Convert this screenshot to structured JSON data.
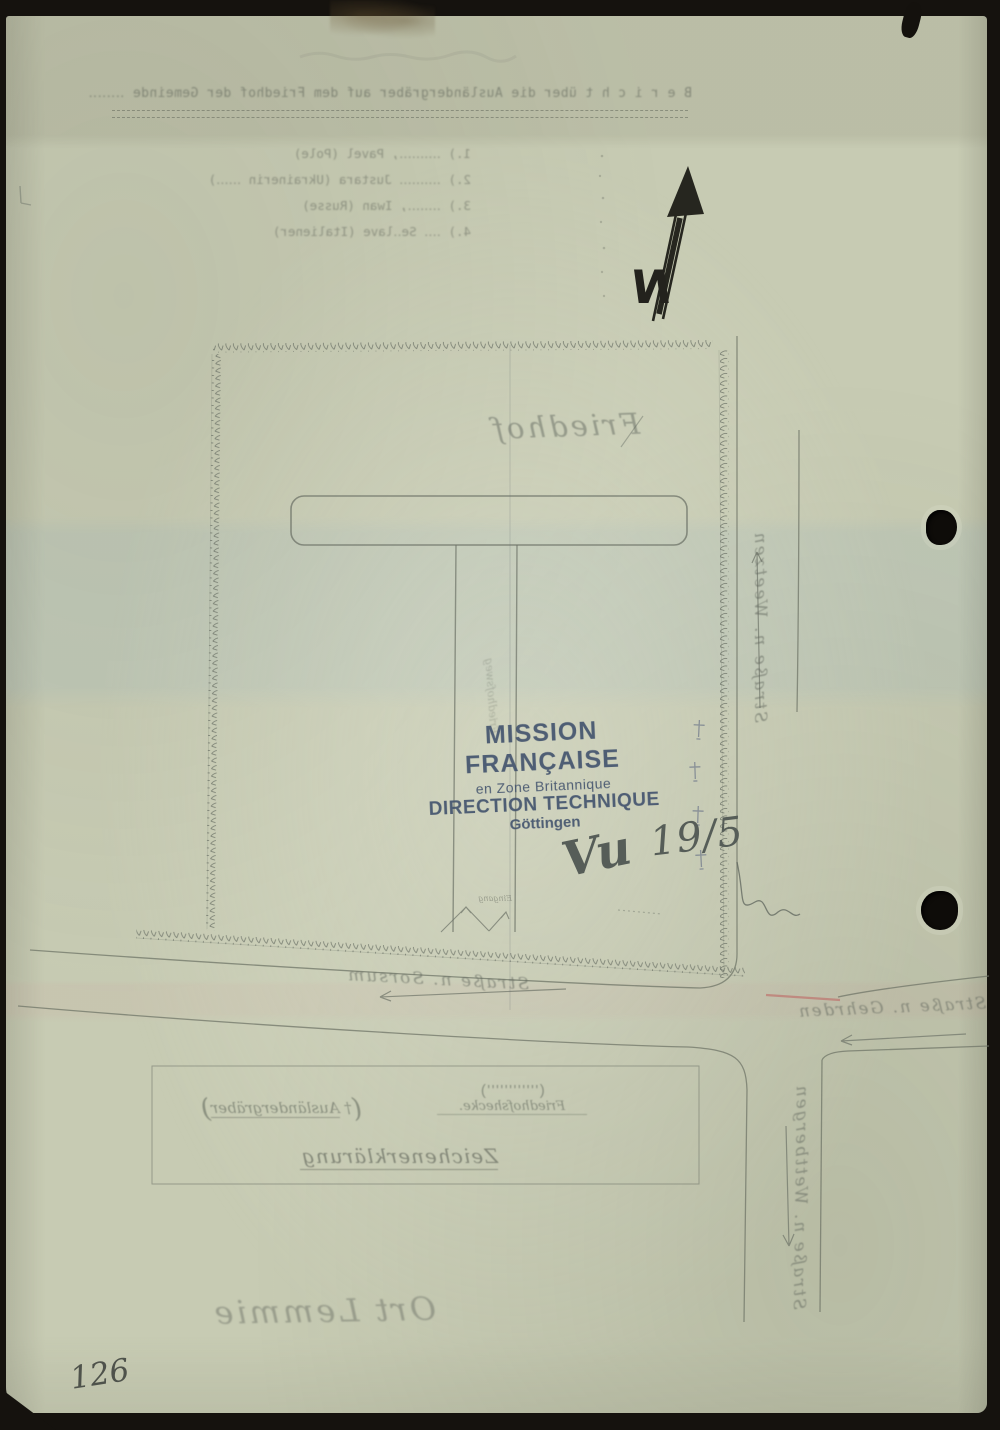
{
  "document": {
    "page_number": "126",
    "stamp": {
      "line1": "MISSION FRANÇAISE",
      "line2": "en Zone Britannique",
      "line3": "DIRECTION TECHNIQUE",
      "line4": "Göttingen",
      "ink_color": "#44546e"
    },
    "handwritten": {
      "vu": "Vu",
      "date": "19/5"
    },
    "map": {
      "north_label": "N",
      "area_label": "Friedhof",
      "path_label": "Friedhofsweg",
      "gate_label": "Eingang",
      "village_label": "Ort Lemmie",
      "streets": {
        "north": "Straße n. Weetzen",
        "south": "Straße n. Sorsum",
        "east": "Straße n. Gehrden",
        "southeast": "Straße n. Wettbergen"
      },
      "legend": {
        "title": "Zeichenerklärung",
        "hedge": {
          "open": "(",
          "symbol": "''''''''''''",
          "close": ")",
          "label": "Friedhofshecke."
        },
        "graves": {
          "open": "(",
          "symbol": "†",
          "label": "Ausländergräber",
          "close": ")"
        }
      }
    },
    "bleed_through": {
      "heading": "B e r i c h t  über die Ausländergräber auf dem Friedhof der Gemeinde ‥‥‥‥",
      "list": [
        "1.) ‥‥‥‥‥, Pavel (Pole)",
        "2.) ‥‥‥‥‥ Justara (Ukrainerin ‥‥‥)",
        "3.) ‥‥‥‥, Iwan (Russe)",
        "4.) ‥‥ Se‥lave (Italiener)"
      ]
    },
    "colors": {
      "paper": "#c7cbb3",
      "sketch_ink": "#6d7368",
      "north_arrow_ink": "#26261f",
      "red_mark": "#bd5555"
    }
  }
}
